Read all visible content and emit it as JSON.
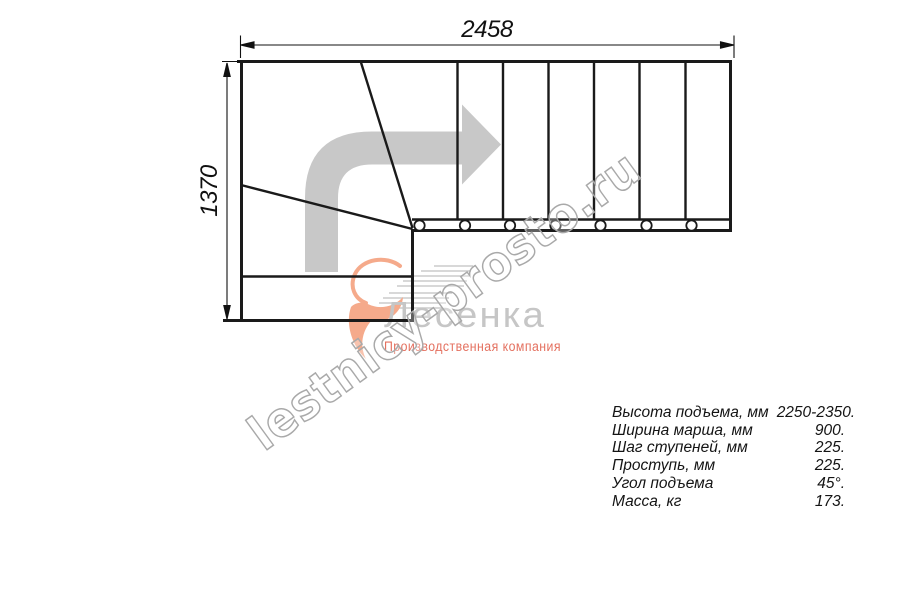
{
  "page": {
    "background": "#ffffff",
    "type": "staircase-plan-drawing"
  },
  "dimension_labels": {
    "width": "2458",
    "height": "1370"
  },
  "drawing": {
    "kind": "L-shaped staircase top view with winder steps and straight flight",
    "straight_flight_steps": 7,
    "baluster_count": 7,
    "direction_arrow": "up-then-right",
    "colors": {
      "line": "#1a1a1a",
      "arrow_fill": "#c8c8c8"
    }
  },
  "watermark": {
    "site_text": "lestnicy-prosto.ru",
    "brand_text": "Лесенка",
    "brand_caption": "Производственная компания",
    "colors": {
      "outline": "#a9a9a9",
      "brand": "#c6c6c6",
      "caption": "#e4705f",
      "logo": "#f5aa8b",
      "speed_lines": "#cbcbcb"
    }
  },
  "specs": {
    "rows": [
      {
        "label": "Высота подъема, мм",
        "value": "2250-2350."
      },
      {
        "label": "Ширина марша, мм",
        "value": "900."
      },
      {
        "label": "Шаг ступеней, мм",
        "value": "225."
      },
      {
        "label": "Проступь, мм",
        "value": "225."
      },
      {
        "label": "Угол подъема",
        "value": "45°."
      },
      {
        "label": "Масса, кг",
        "value": "173."
      }
    ]
  }
}
